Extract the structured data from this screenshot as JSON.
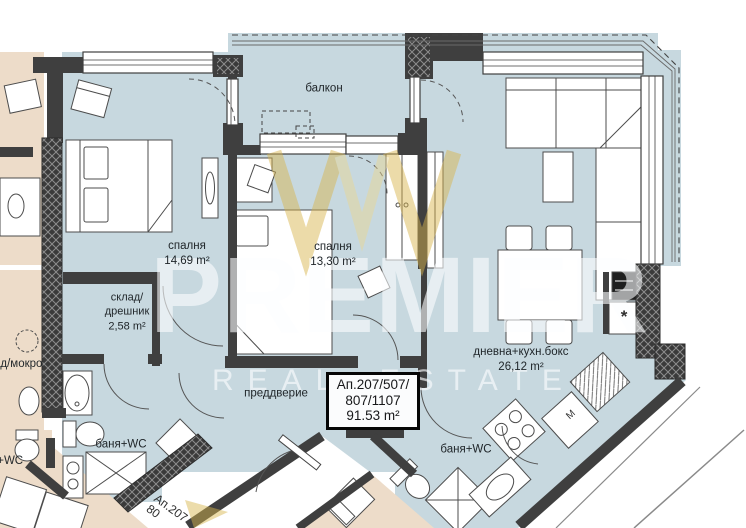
{
  "watermark": {
    "brand": "PREMIER",
    "tagline": "REAL ESTATE"
  },
  "rooms": {
    "balcony": {
      "name": "балкон"
    },
    "bedroom1": {
      "name": "спалня",
      "area": "14,69 m²"
    },
    "bedroom2": {
      "name": "спалня",
      "area": "13,30 m²"
    },
    "storage": {
      "name_line1": "склад/",
      "name_line2": "дрешник",
      "area": "2,58 m²"
    },
    "living": {
      "name": "дневна+кухн.бокс",
      "area": "26,12 m²"
    },
    "hallway": {
      "name": "преддверие"
    },
    "bath_left": {
      "name": "баня+WC"
    },
    "bath_right": {
      "name": "баня+WC"
    }
  },
  "apartment_box": {
    "line1": "Ап.207/507/",
    "line2": "807/1107",
    "line3": "91.53 m²"
  },
  "neighbors": {
    "left_room_partial": "ад/мокро",
    "bottom_left_partial": "я+WC",
    "stairwell_line1": "Ап.207",
    "stairwell_line2": "80"
  },
  "markers": {
    "washing_machine": "M",
    "fridge_star": "*"
  },
  "colors": {
    "apartment_floor": "#c7d8df",
    "neighbor_floor": "#eddcc9",
    "wall": "#3f3f3f",
    "watermark_gold": "#d8b54e"
  }
}
